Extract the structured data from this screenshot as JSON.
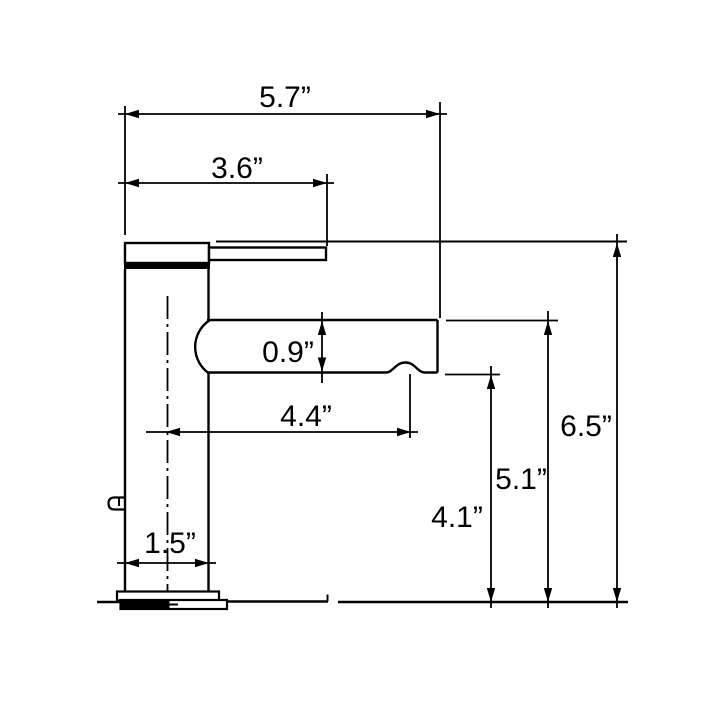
{
  "drawing": {
    "colors": {
      "line": "#000000",
      "background": "#ffffff"
    },
    "dimensions": {
      "overall_spout_width": {
        "label": "5.7”",
        "value": 5.7
      },
      "handle_reach": {
        "label": "3.6”",
        "value": 3.6
      },
      "spout_thickness": {
        "label": "0.9”",
        "value": 0.9
      },
      "spout_reach_from_center": {
        "label": "4.4”",
        "value": 4.4
      },
      "overall_height": {
        "label": "6.5”",
        "value": 6.5
      },
      "height_to_spout_top": {
        "label": "5.1”",
        "value": 5.1
      },
      "height_to_spout_bottom": {
        "label": "4.1”",
        "value": 4.1
      },
      "body_base_width": {
        "label": "1.5”",
        "value": 1.5
      }
    }
  }
}
